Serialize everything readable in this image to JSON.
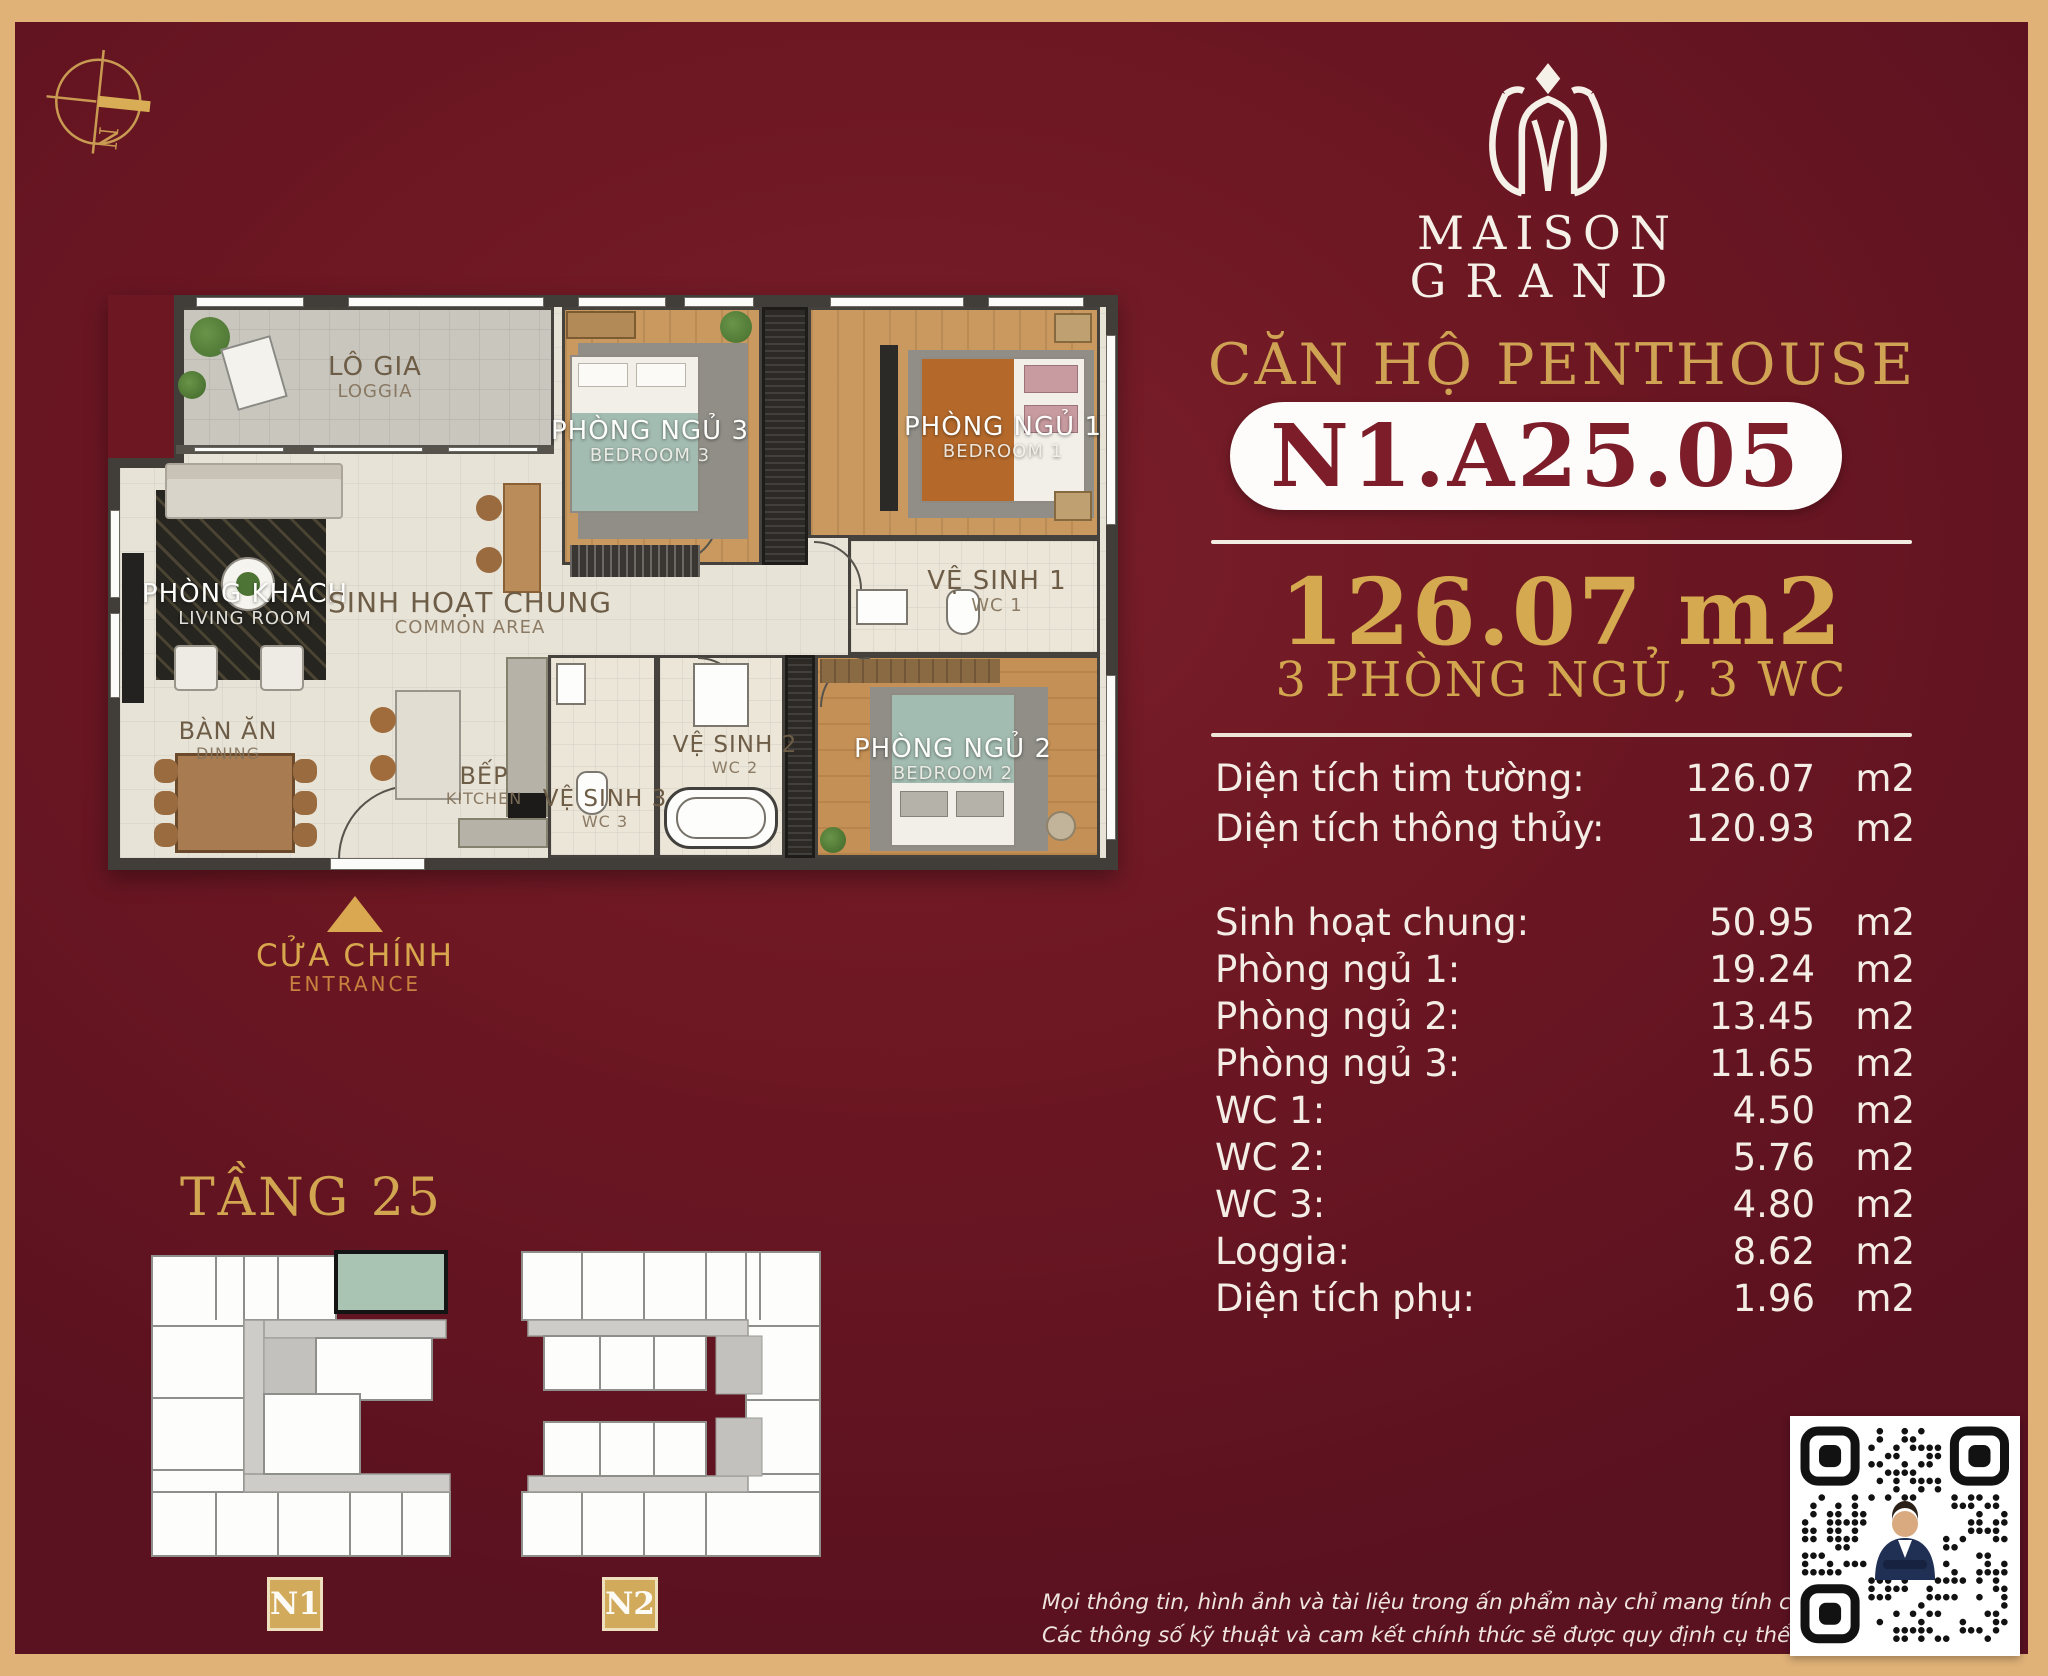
{
  "brand": {
    "logo": "maison-grand-lotus-mark",
    "name_line1": "MAISON",
    "name_line2": "GRAND"
  },
  "header": {
    "subtitle": "CĂN HỘ PENTHOUSE",
    "unit_code": "N1.A25.05",
    "area_total": "126.07 m2",
    "config": "3 PHÒNG NGỦ, 3 WC"
  },
  "area_table": {
    "unit": "m2",
    "rows": [
      {
        "label": "Diện tích tim tường:",
        "value": "126.07",
        "group": 1
      },
      {
        "label": "Diện tích thông thủy:",
        "value": "120.93",
        "group": 1
      },
      {
        "label": "Sinh hoạt chung:",
        "value": "50.95",
        "group": 2
      },
      {
        "label": "Phòng ngủ 1:",
        "value": "19.24",
        "group": 2
      },
      {
        "label": "Phòng ngủ 2:",
        "value": "13.45",
        "group": 2
      },
      {
        "label": "Phòng ngủ 3:",
        "value": "11.65",
        "group": 2
      },
      {
        "label": "WC 1:",
        "value": "4.50",
        "group": 2
      },
      {
        "label": "WC 2:",
        "value": "5.76",
        "group": 2
      },
      {
        "label": "WC 3:",
        "value": "4.80",
        "group": 2
      },
      {
        "label": "Loggia:",
        "value": "8.62",
        "group": 2
      },
      {
        "label": "Diện tích phụ:",
        "value": "1.96",
        "group": 2
      }
    ]
  },
  "floor_plan": {
    "rooms": {
      "loggia": {
        "vi": "LÔ GIA",
        "en": "LOGGIA"
      },
      "living": {
        "vi": "PHÒNG KHÁCH",
        "en": "LIVING ROOM"
      },
      "common": {
        "vi": "SINH HOẠT CHUNG",
        "en": "COMMON AREA"
      },
      "dining": {
        "vi": "BÀN ĂN",
        "en": "DINING"
      },
      "kitchen": {
        "vi": "BẾP",
        "en": "KITCHEN"
      },
      "bedroom1": {
        "vi": "PHÒNG NGỦ 1",
        "en": "BEDROOM 1"
      },
      "bedroom2": {
        "vi": "PHÒNG NGỦ 2",
        "en": "BEDROOM 2"
      },
      "bedroom3": {
        "vi": "PHÒNG NGỦ 3",
        "en": "BEDROOM 3"
      },
      "wc1": {
        "vi": "VỆ SINH 1",
        "en": "WC 1"
      },
      "wc2": {
        "vi": "VỆ SINH 2",
        "en": "WC 2"
      },
      "wc3": {
        "vi": "VỆ SINH 3",
        "en": "WC 3"
      }
    },
    "entrance": {
      "vi": "CỬA CHÍNH",
      "en": "ENTRANCE"
    }
  },
  "floor_section": {
    "title": "TẦNG 25",
    "buildings": [
      {
        "label": "N1"
      },
      {
        "label": "N2"
      }
    ],
    "highlight_unit_color": "#a9c4b2"
  },
  "compass": {
    "label": "N"
  },
  "disclaimer": {
    "line1": "Mọi thông tin, hình ảnh và tài liệu trong ấn phẩm này chỉ mang tính chất tham khảo và minh họa tại thời",
    "line2": "Các thông số kỹ thuật và cam kết chính thức sẽ được quy định cụ thể và chi tiết trong Hợp đồng Mua bán"
  },
  "colors": {
    "background": "#6c1722",
    "frame_gold": "#e0b278",
    "accent_gold": "#cfa254",
    "badge_text": "#7c1d29",
    "highlight_unit": "#a9c4b2"
  }
}
